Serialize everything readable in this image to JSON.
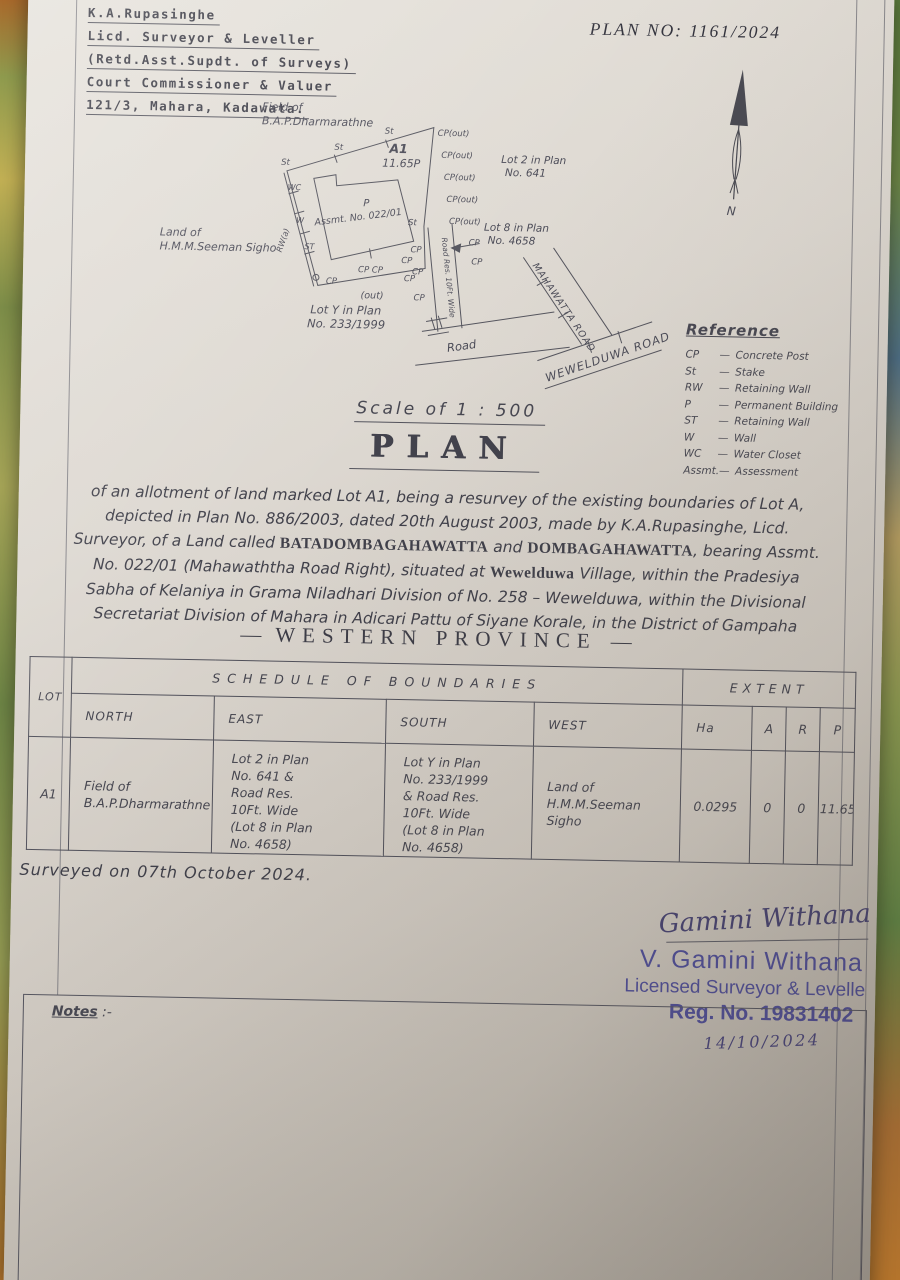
{
  "header": {
    "plan_no": "PLAN  NO:  1161/2024",
    "surveyor_lines": [
      "K.A.Rupasinghe",
      "Licd. Surveyor & Leveller",
      "(Retd.Asst.Supdt. of Surveys)",
      "Court Commissioner & Valuer",
      "121/3, Mahara, Kadawata."
    ]
  },
  "drawing": {
    "field_of_1": "Field of",
    "field_of_2": "B.A.P.Dharmarathne",
    "lot_id": "A1",
    "lot_area": "11.65P",
    "building_p": "P",
    "assmt": "Assmt.  No.  022/01",
    "lot2_1": "Lot 2 in Plan",
    "lot2_2": "No. 641",
    "lot8_1": "Lot 8 in Plan",
    "lot8_2": "No. 4658",
    "lot_y_1": "Lot Y in Plan",
    "lot_y_2": "No. 233/1999",
    "land_1": "Land of",
    "land_2": "H.M.M.Seeman Sigho",
    "road": "Road",
    "road_res": "Road Res. 10Ft. Wide",
    "mahawatta_road": "MAHAWATTA  ROAD",
    "wewelduwa_road": "WEWELDUWA  ROAD",
    "out": "(out)",
    "m_cp_out": "CP(out)",
    "m_cp": "CP",
    "m_cp_cp": "CP CP",
    "m_st_small": "St",
    "m_st_big": "ST",
    "m_wc": "WC",
    "m_w": "W",
    "m_rw": "RW(a)",
    "north_letter": "N"
  },
  "reference": {
    "title": "Reference",
    "dash": "—",
    "items": [
      {
        "abbr": "CP",
        "meaning": "Concrete Post"
      },
      {
        "abbr": "St",
        "meaning": "Stake"
      },
      {
        "abbr": "RW",
        "meaning": "Retaining Wall"
      },
      {
        "abbr": "P",
        "meaning": "Permanent Building"
      },
      {
        "abbr": "ST",
        "meaning": "Retaining Wall"
      },
      {
        "abbr": "W",
        "meaning": "Wall"
      },
      {
        "abbr": "WC",
        "meaning": "Water Closet"
      },
      {
        "abbr": "Assmt.",
        "meaning": "Assessment"
      }
    ]
  },
  "scale_line": "Scale of 1 : 500",
  "plan_title": "PLAN",
  "description": {
    "seg1": "of an allotment of land marked Lot A1, being a resurvey of the existing boundaries of Lot A, depicted in Plan No. 886/2003, dated 20th August 2003, made by K.A.Rupasinghe, Licd. Surveyor, of a Land called ",
    "bold1": "BATADOMBAGAHAWATTA",
    "seg2": " and ",
    "bold2": "DOMBAGAHAWATTA",
    "seg3": ", bearing Assmt. No. 022/01 (Mahawaththa Road Right), situated at ",
    "bold3": "Wewelduwa",
    "seg4": " Village, within the Pradesiya Sabha of Kelaniya in Grama Niladhari Division of No. 258 – Wewelduwa, within the Divisional Secretariat Division of Mahara in Adicari Pattu of Siyane Korale, in the District of Gampaha"
  },
  "province": {
    "dash": "—",
    "text": "WESTERN   PROVINCE"
  },
  "table": {
    "title_boundaries": "SCHEDULE   OF   BOUNDARIES",
    "title_extent": "EXTENT",
    "col_lot": "LOT",
    "cols": [
      "NORTH",
      "EAST",
      "SOUTH",
      "WEST",
      "Ha",
      "A",
      "R",
      "P"
    ],
    "rows": [
      [
        "A1",
        "Field of\nB.A.P.Dharmarathne",
        "Lot 2 in Plan\nNo. 641 &\nRoad Res.\n10Ft. Wide\n(Lot 8 in Plan\nNo. 4658)",
        "Lot Y in Plan\nNo. 233/1999\n& Road Res.\n10Ft. Wide\n(Lot 8 in Plan\nNo. 4658)",
        "Land of\nH.M.M.Seeman Sigho",
        "0.0295",
        "0",
        "0",
        "11.65"
      ]
    ]
  },
  "surveyed_on": "Surveyed on 07th October 2024.",
  "signature": {
    "handwritten": "Gamini Withana",
    "stamp_name": "V. Gamini Withana",
    "stamp_title": "Licensed Surveyor & Levelle",
    "stamp_reg": "Reg. No. 19831402",
    "date": "14/10/2024"
  },
  "notes": {
    "label": "Notes",
    "punct": " :-"
  }
}
